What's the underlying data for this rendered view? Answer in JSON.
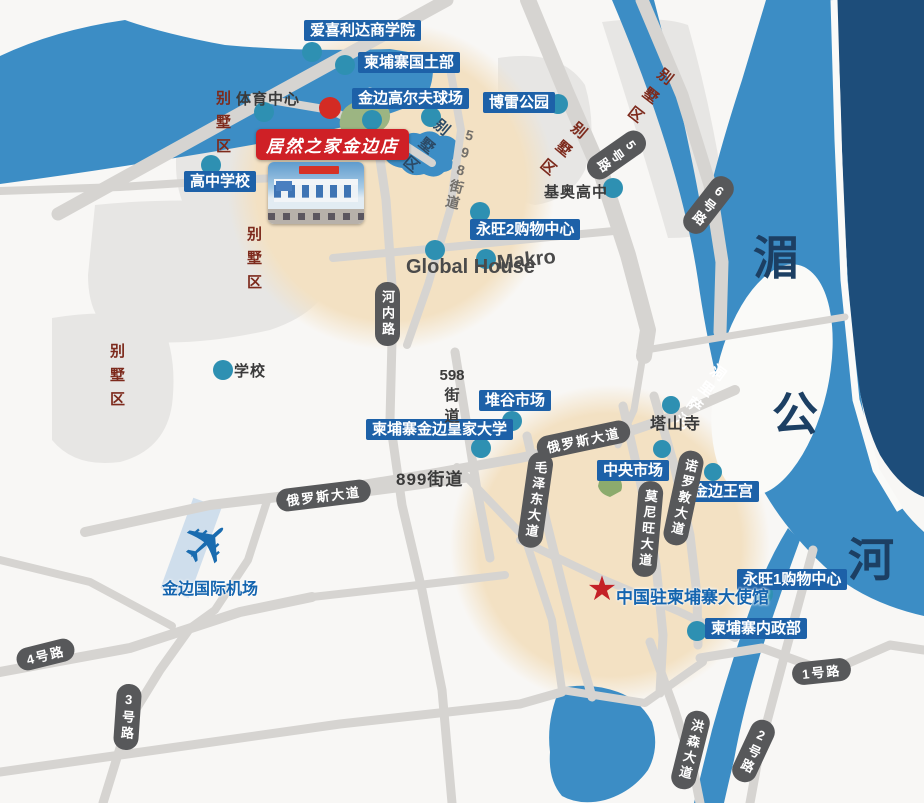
{
  "store": {
    "label": "居然之家金边店"
  },
  "rivers": {
    "mekong_chars": [
      "湄",
      "公",
      "河"
    ],
    "tonle_sap": "洞里萨河"
  },
  "areas": {
    "villa": "别墅区"
  },
  "pois": {
    "business_school": "爱喜利达商学院",
    "land_ministry": "柬埔寨国土部",
    "golf_course": "金边高尔夫球场",
    "borey_park": "博雷公园",
    "sports_center": "体育中心",
    "high_school": "高中学校",
    "kio_high_school": "基奥高中",
    "aeon2_mall": "永旺2购物中心",
    "global_house": "Global House",
    "makro": "Makro",
    "school": "学校",
    "tuol_kork_market": "堆谷市场",
    "royal_university": "柬埔寨金边皇家大学",
    "central_market": "中央市场",
    "royal_palace": "金边王宫",
    "wat_phnom": "塔山寺",
    "aeon1_mall": "永旺1购物中心",
    "interior_ministry": "柬埔寨内政部",
    "china_embassy": "中国驻柬埔寨大使馆",
    "airport": "金边国际机场"
  },
  "roads": {
    "road1": "1号路",
    "road2": "2号路",
    "road3": "3号路",
    "road4": "4号路",
    "road5": "5号路",
    "road6": "6号路",
    "hanoi_road": "河内路",
    "russian_blvd": "俄罗斯大道",
    "mao_zedong_blvd": "毛泽东大道",
    "monivong_blvd": "莫尼旺大道",
    "norodom_blvd": "诺罗敦大道",
    "hun_sen_blvd": "洪森大道",
    "st598": "598街道",
    "st598_lines": [
      "598",
      "街",
      "道"
    ],
    "st899": "899街道"
  },
  "icons": {
    "airplane": "✈",
    "star": "★"
  },
  "colors": {
    "water": "#3C8DC5",
    "deep_water": "#1D4D7A",
    "highlight_circle": "#F3E1C3",
    "road": "#D6D4D1",
    "poi_label_bg": "#1D61A8",
    "store_label_bg": "#CF2026",
    "marker_teal": "#2E90B2",
    "marker_red": "#D32B24",
    "road_pill_bg": "#57585A"
  }
}
